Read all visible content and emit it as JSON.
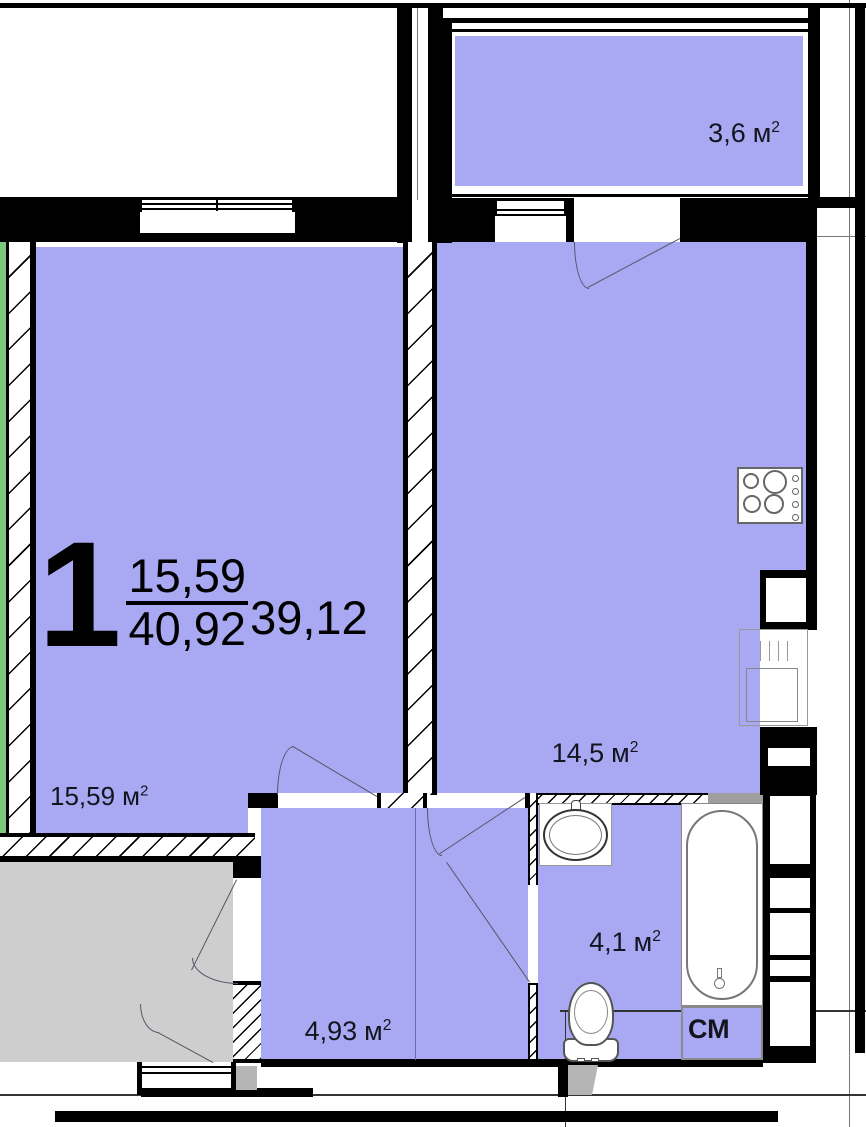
{
  "plan": {
    "summary": {
      "rooms_count": "1",
      "living_area": "15,59",
      "total_area": "40,92",
      "reduced_area": "39,12"
    },
    "areas": {
      "balcony": {
        "value": "3,6",
        "unit": "м",
        "exp": "2"
      },
      "living": {
        "value": "15,59",
        "unit": "м",
        "exp": "2"
      },
      "kitchen": {
        "value": "14,5",
        "unit": "м",
        "exp": "2"
      },
      "hallway": {
        "value": "4,93",
        "unit": "м",
        "exp": "2"
      },
      "bathroom": {
        "value": "4,1",
        "unit": "м",
        "exp": "2"
      }
    },
    "fixtures": {
      "washing_machine": "СМ"
    },
    "colors": {
      "room_fill": "#a9a9f3",
      "corridor_fill": "#cecece",
      "insulation_green": "#7cc87c",
      "wall": "#000000"
    }
  }
}
